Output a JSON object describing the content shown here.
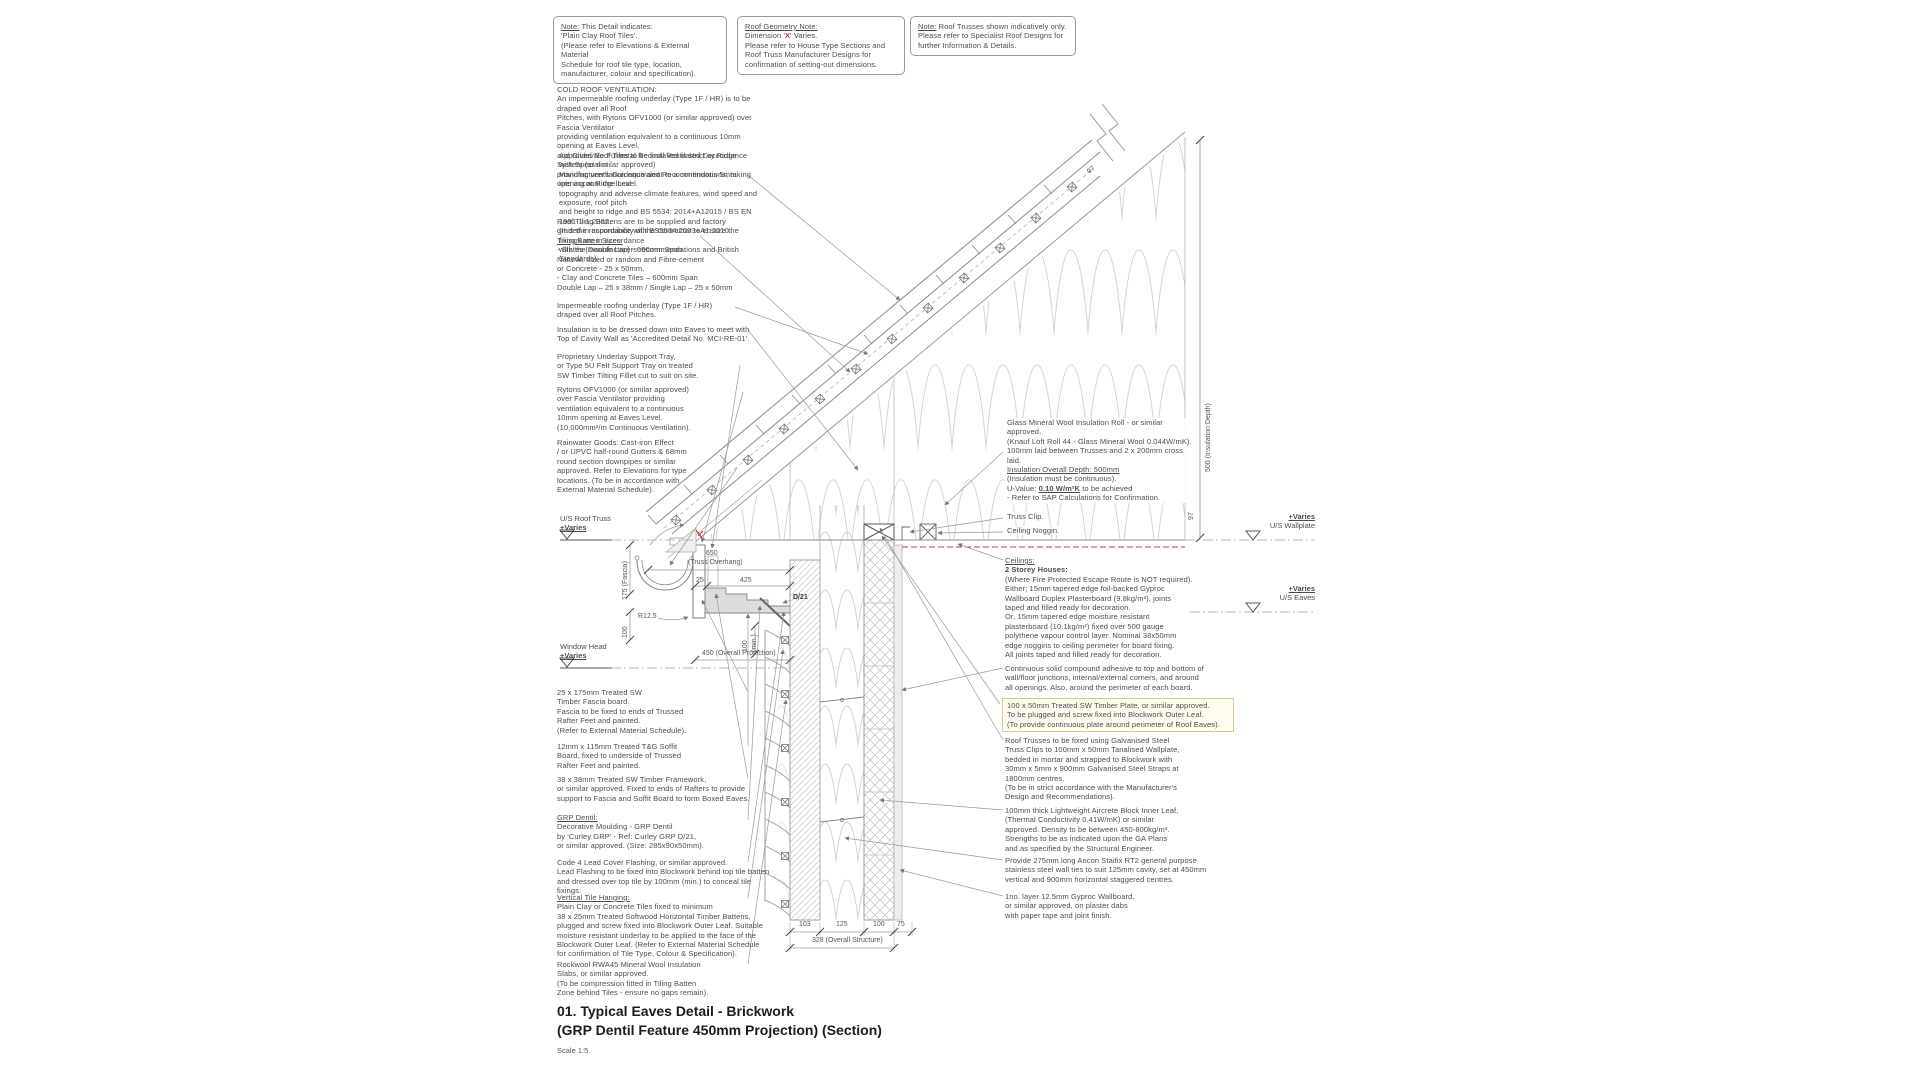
{
  "colors": {
    "accent_red": "#c0392b",
    "line_grey": "#8a8a8a",
    "highlight": "#fffdf0"
  },
  "notes": [
    {
      "label": "Note:",
      "rest": " This Detail indicates:",
      "lines": [
        "'Plain Clay Roof Tiles'.",
        "(Please refer to Elevations & External Material",
        "Schedule for roof tile type, location,",
        "manufacturer, colour and specification)."
      ]
    },
    {
      "heading": "Roof Geometry Note:",
      "dim_pre": "Dimension '",
      "dim_x": "X",
      "dim_post": "' Varies.",
      "lines": [
        "Please refer to House Type Sections and",
        "Roof Truss Manufacturer Designs for",
        "confirmation of setting-out dimensions."
      ]
    },
    {
      "label": "Note:",
      "rest": " Roof Trusses shown indicatively only.",
      "lines": [
        "Please refer to Specialist Roof Designs for",
        "further Information & Details."
      ]
    }
  ],
  "left": [
    {
      "lines": [
        "COLD ROOF VENTILATION:",
        "An impermeable roofing underlay (Type 1F / HR)  is to be draped over all Roof",
        "Pitches, with Rytons OFV1000 (or similar approved) over Fascia Ventilator",
        "providing ventilation equivalent to a continuous 10mm opening at Eaves Level,",
        "and Glidevale Fulmetal Rediroll Ventilated Dry Ridge System (or similar approved)",
        "providing ventilation equivalent to a continuous 5mm opening at Ridge Level."
      ]
    },
    {
      "lines": [
        "Approved Roof Tiles to be installed in strict accordance with Specialist",
        "Manufacturer's Guidance and Recommendations, taking into account the local",
        "topography and adverse climate features, wind speed and exposure, roof pitch",
        "and height to ridge and BS 5534: 2014+A12015 / BS EN 1991-1-1:2002.",
        "(It is the responsibility of the contractor to ensure the fixings are in accordance",
        "with the manufacturers recommendations and British Standards)."
      ]
    },
    {
      "lines": [
        "Roof Tiling Battens are to be supplied and factory",
        "graded in accordance with BS5534:2003+A1:2010."
      ],
      "u": "Tiling Batten Sizes:",
      "lines2": [
        "- Slates (Double Lap) - 600mm Span",
        "Natural, sized or random and Fibre-cement",
        "or Concrete - 25 x 50mm.",
        "- Clay and Concrete Tiles – 600mm Span",
        "Double Lap – 25 x 38mm / Single Lap – 25 x 50mm"
      ]
    },
    {
      "lines": [
        "Impermeable roofing underlay (Type 1F / HR)",
        "draped over all Roof Pitches."
      ]
    },
    {
      "lines": [
        "Insulation is to be dressed down into Eaves to meet with",
        "Top of Cavity Wall as 'Accredited Detail No. MCI-RE-01'."
      ]
    },
    {
      "lines": [
        "Proprietary Underlay Support Tray,",
        "or Type 5U Felt Support Tray on treated",
        "SW Timber Tilting Fillet cut to suit on site."
      ]
    },
    {
      "lines": [
        "Rytons OFV1000 (or similar approved)",
        "over Fascia Ventilator providing",
        "ventilation equivalent to a continuous",
        "10mm opening at Eaves Level.",
        "(10,000mm²/m Continuous Ventilation)."
      ]
    },
    {
      "lines": [
        "Rainwater Goods: Cast-iron Effect",
        "/ or UPVC half-round Gutters & 68mm",
        "round section downpipes or similar",
        "approved. Refer to Elevations for type",
        "locations. (To be in accordance with",
        "External Material Schedule)."
      ]
    },
    {
      "lines": [
        "25 x 175mm Treated SW",
        "Timber Fascia board.",
        "Fascia to be fixed to ends of Trussed",
        "Rafter Feet and painted.",
        "(Refer to External Material Schedule)."
      ]
    },
    {
      "lines": [
        "12mm x 115mm Treated T&G Soffit",
        "Board, fixed to underside of Trussed",
        "Rafter Feet and painted."
      ]
    },
    {
      "lines": [
        "38 x 38mm Treated SW Timber Framework,",
        "or similar approved. Fixed to ends of Rafters to provide",
        "support to Fascia and Soffit Board to form Boxed Eaves."
      ]
    },
    {
      "u": "GRP Dentil:",
      "lines": [
        "Decorative Moulding - GRP Dentil",
        "by 'Curley GRP' - Ref: Curley GRP D/21,",
        "or similar approved. (Size: 285x90x50mm)."
      ]
    },
    {
      "lines": [
        "Code 4 Lead Cover Flashing, or similar approved.",
        "Lead Flashing to be fixed into Blockwork behind top tile batten",
        "and dressed over top tile by 100mm (min.) to conceal tile fixings."
      ]
    },
    {
      "u": "Vertical Tile Hanging:",
      "lines": [
        "Plain Clay or Concrete Tiles fixed to minimum",
        "38 x 25mm Treated Softwood Horizontal Timber Battens,",
        "plugged and screw fixed into Blockwork Outer Leaf. Suitable",
        "moisture resistant underlay to be applied to the face of the",
        "Blockwork Outer Leaf. (Refer to External Material Schedule",
        "for confirmation of Tile Type, Colour & Specification)."
      ]
    },
    {
      "lines": [
        "Rockwool RWA45 Mineral Wool Insulation",
        "Slabs, or similar approved.",
        "(To be compression fitted in Tiling Batten",
        "Zone behind Tiles - ensure no gaps remain)."
      ]
    }
  ],
  "right": [
    {
      "lines": [
        "Glass Mineral Wool Insulation Roll - or similar approved.",
        "(Knauf Loft Roll 44 - Glass Mineral Wool 0.044W/mK).",
        "100mm laid between Trusses and 2 x 200mm cross laid."
      ],
      "u": "Insulation Overall Depth: 500mm",
      "lines2": [
        "(Insulation must be continuous)."
      ],
      "uv_pre": "U-Value: ",
      "uv_u": "0.10 W/m²K",
      "uv_post": " to be achieved",
      "lines3": [
        "- Refer to SAP Calculations for Confirmation."
      ]
    },
    {
      "label": "Truss Clip."
    },
    {
      "label": "Ceiling Noggin."
    },
    {
      "u": "Ceilings:",
      "b": "2 Storey Houses:",
      "lines": [
        "(Where Fire Protected Escape Route is NOT required).",
        "Either; 15mm tapered edge foil-backed Gyproc",
        "Wallboard Duplex Plasterboard (9.8kg/m²), joints",
        "taped and filled ready for decoration.",
        "Or, 15mm tapered edge moisture resistant",
        "plasterboard (10.1kg/m²) fixed over 500 gauge",
        "polythene vapour control layer. Nominal 38x50mm",
        "edge noggins to ceiling perimeter for board fixing.",
        "All joints taped and filled ready for decoration."
      ]
    },
    {
      "lines": [
        "Continuous solid compound adhesive to top and bottom of",
        "wall/floor junctions, internal/external corners, and around",
        "all openings. Also, around the perimeter of each board."
      ]
    },
    {
      "lines": [
        "100 x 50mm Treated SW Timber Plate, or similar approved.",
        "To be plugged and screw fixed into Blockwork Outer Leaf.",
        "(To provide continuous plate around perimeter of Roof Eaves)."
      ]
    },
    {
      "lines": [
        "Roof Trusses to be fixed using Galvanised Steel",
        "Truss Clips to 100mm x 50mm Tanalised Wallplate,",
        "bedded in mortar and strapped to Blockwork with",
        "30mm x 5mm x 900mm Galvanised Steel Straps at",
        "1800mm centres.",
        "(To be in strict accordance with the Manufacturer's",
        "Design and Recommendations)."
      ]
    },
    {
      "lines": [
        "100mm thick Lightweight Aircrete Block Inner Leaf,",
        "(Thermal Conductivity 0.41W/mK) or similar",
        "approved. Density to be between 450-800kg/m³.",
        "Strengths to be as indicated upon the GA Plans",
        "and as specified by the Structural Engineer."
      ]
    },
    {
      "lines": [
        "Provide 275mm long Ancon Staifix RT2 general purpose",
        "stainless steel wall ties to suit 125mm cavity, set at 450mm",
        "vertical and 900mm horizontal staggered centres."
      ]
    },
    {
      "lines": [
        "1no. layer 12.5mm Gyproc Wallboard,",
        "or similar approved, on plaster dabs",
        "with paper tape and joint finish."
      ]
    }
  ],
  "markers": {
    "varies": "+Varies",
    "us_roof_truss": "U/S Roof Truss",
    "window_head": "Window Head",
    "us_wallplate": "U/S Wallplate",
    "us_eaves": "U/S Eaves"
  },
  "dims": {
    "overhang": "650",
    "overhang_label": "(Truss Overhang)",
    "d25": "25",
    "d425": "425",
    "projection": "450 (Overall Projection)",
    "fascia175": "175 (Fascia)",
    "d100": "100",
    "r125": "R12.5",
    "min100": "100\n(min.)",
    "d21": "D/21",
    "b103": "103",
    "b125": "125",
    "b100": "100",
    "b75": "75",
    "overall": "328 (Overall Structure)",
    "ins500": "500 (Insulation Depth)",
    "d97a": "97",
    "d97b": "97"
  },
  "title": {
    "line1": "01. Typical Eaves Detail - Brickwork",
    "line2": "(GRP Dentil Feature 450mm Projection) (Section)",
    "scale": "Scale 1:5"
  }
}
